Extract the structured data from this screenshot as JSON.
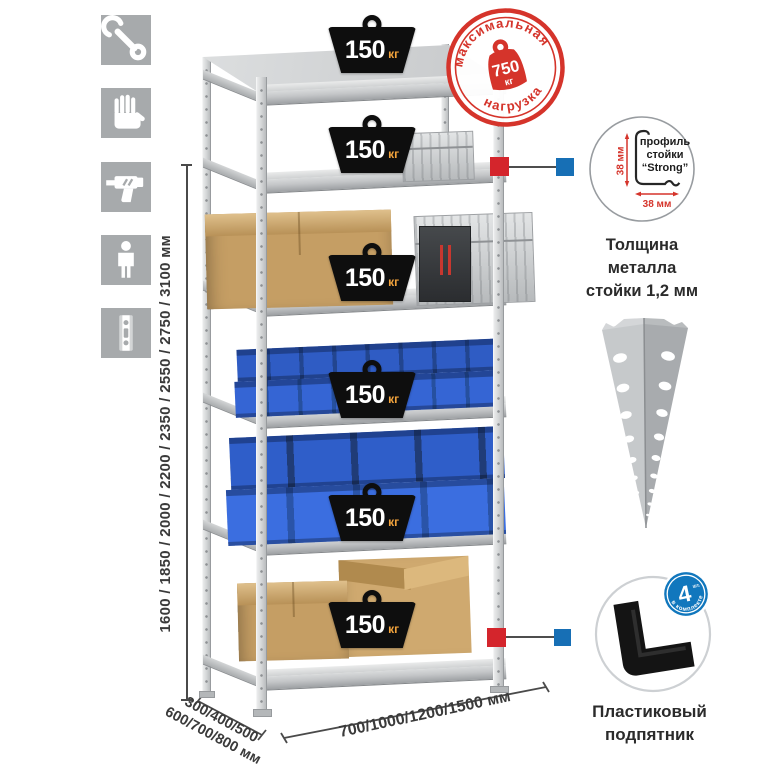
{
  "stamp": {
    "arc_top": "максимальная",
    "arc_bottom": "нагрузка",
    "weight_value": "750",
    "weight_unit": "кг"
  },
  "shelf_badge": {
    "value": "150",
    "unit": "кг"
  },
  "height_dim": {
    "label": "1600 / 1850 / 2000 / 2200 / 2350 / 2550 / 2750 / 3100 мм"
  },
  "depth_dim": {
    "line1": "300/400/500",
    "line2": "600/700/800 мм"
  },
  "width_dim": {
    "label": "700/1000/1200/1500 мм"
  },
  "profile_detail": {
    "label_line1": "профиль",
    "label_line2": "стойки",
    "label_line3": "“Strong”",
    "dim_vertical": "38 мм",
    "dim_horizontal": "38 мм",
    "caption_line1": "Толщина металла",
    "caption_line2": "стойки 1,2 мм"
  },
  "foot_detail": {
    "badge_count": "4",
    "badge_count_suffix": "шт.",
    "badge_arc": "в комплекте",
    "caption_line1": "Пластиковый",
    "caption_line2": "подпятник"
  },
  "icons": {
    "icon1": "wrench-icon",
    "icon2": "gloves-icon",
    "icon3": "drill-icon",
    "icon4": "person-icon",
    "icon5": "post-profile-icon"
  },
  "colors": {
    "stamp_red": "#d5342b",
    "badge_black": "#0e0e0e",
    "kg_orange": "#f2a33c",
    "bin_blue": "#3161cd",
    "callout_red": "#d4252c",
    "callout_blue": "#176fb5",
    "metal_gray": "#c9cbcd",
    "icon_gray": "#a7aaac"
  }
}
